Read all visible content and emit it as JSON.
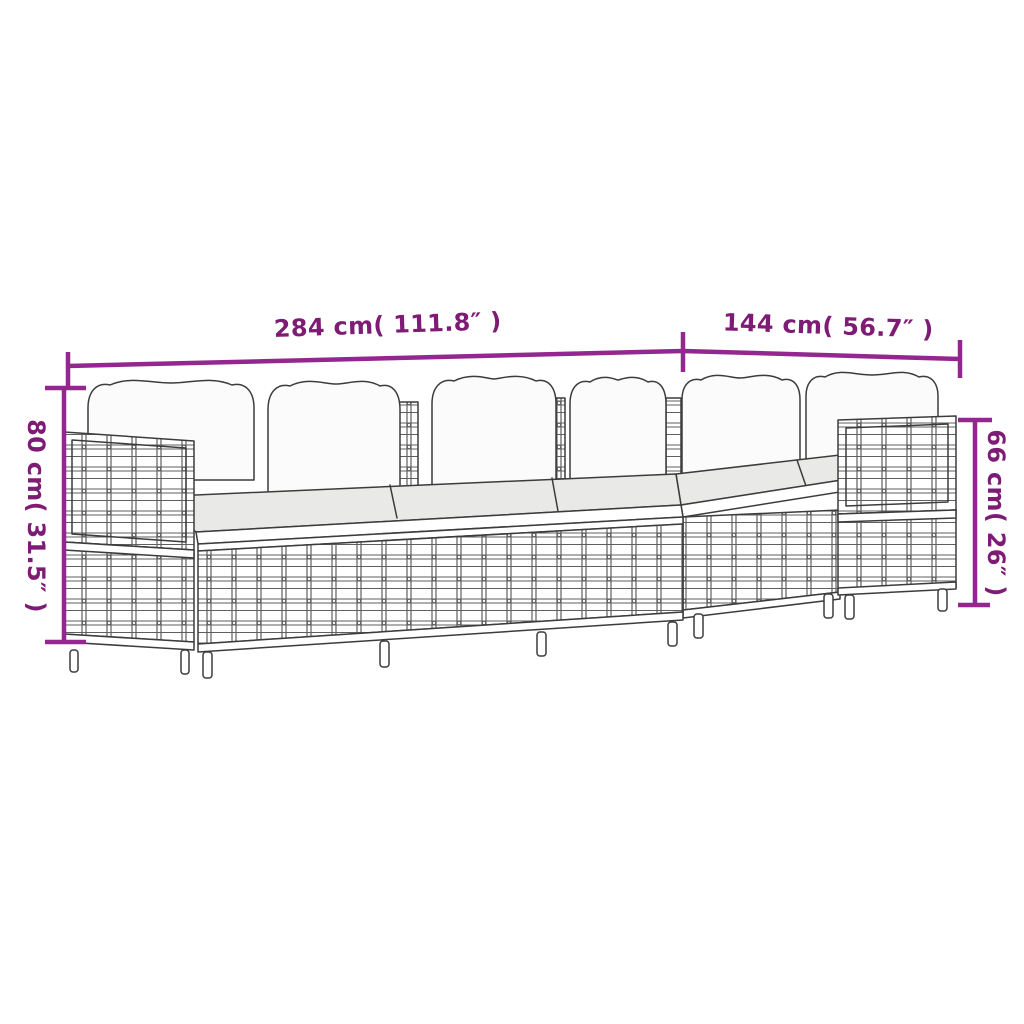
{
  "canvas": {
    "width": 1024,
    "height": 1024,
    "background": "#ffffff"
  },
  "drawing": {
    "kind": "furniture-dimension-line-drawing",
    "subject": "5-piece poly rattan modular garden lounge set with cushions",
    "outline_color": "#3c3c3c",
    "weave_color": "#5f5f5f",
    "back_cushion_color": "#fbfbfb",
    "seat_cushion_color": "#e9e9e8"
  },
  "dimensions": {
    "line_color": "#93278F",
    "text_color": "#7E1B74",
    "measurements": [
      {
        "id": "total-width",
        "label": "284 cm( 111.8″ )",
        "orientation": "horizontal",
        "position": "top-left"
      },
      {
        "id": "side-width",
        "label": "144 cm( 56.7″ )",
        "orientation": "horizontal",
        "position": "top-right"
      },
      {
        "id": "back-height",
        "label": "80 cm( 31.5″ )",
        "orientation": "vertical",
        "position": "left"
      },
      {
        "id": "arm-height",
        "label": "66 cm( 26″ )",
        "orientation": "vertical",
        "position": "right"
      }
    ]
  }
}
